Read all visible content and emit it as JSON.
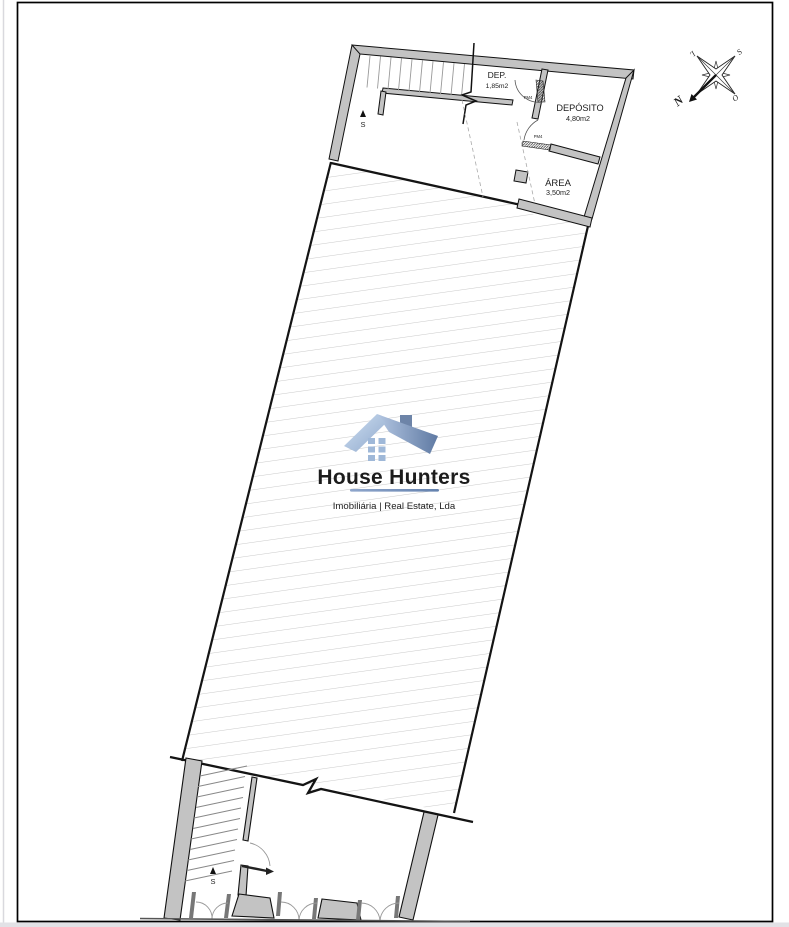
{
  "plan": {
    "rooms": [
      {
        "name": "DEP.",
        "area": "1,85m2"
      },
      {
        "name": "DEPÓSITO",
        "area": "4,80m2"
      },
      {
        "name": "ÁREA",
        "area": "3,50m2"
      }
    ],
    "door_labels": [
      "PM4",
      "PM4"
    ],
    "stair_up_labels": [
      "S",
      "S"
    ],
    "colors": {
      "wall_fill": "#c3c3c3",
      "outline": "#111111",
      "hatch_line": "#bcbcbc"
    }
  },
  "compass": {
    "north": "N",
    "south": "S",
    "east": "L",
    "west": "O"
  },
  "logo": {
    "name": "House Hunters",
    "tagline": "Imobiliária | Real Estate, Lda",
    "text_color": "#3b434e",
    "blue_dark": "#5f7aa3",
    "blue_light": "#cfe0f2"
  }
}
